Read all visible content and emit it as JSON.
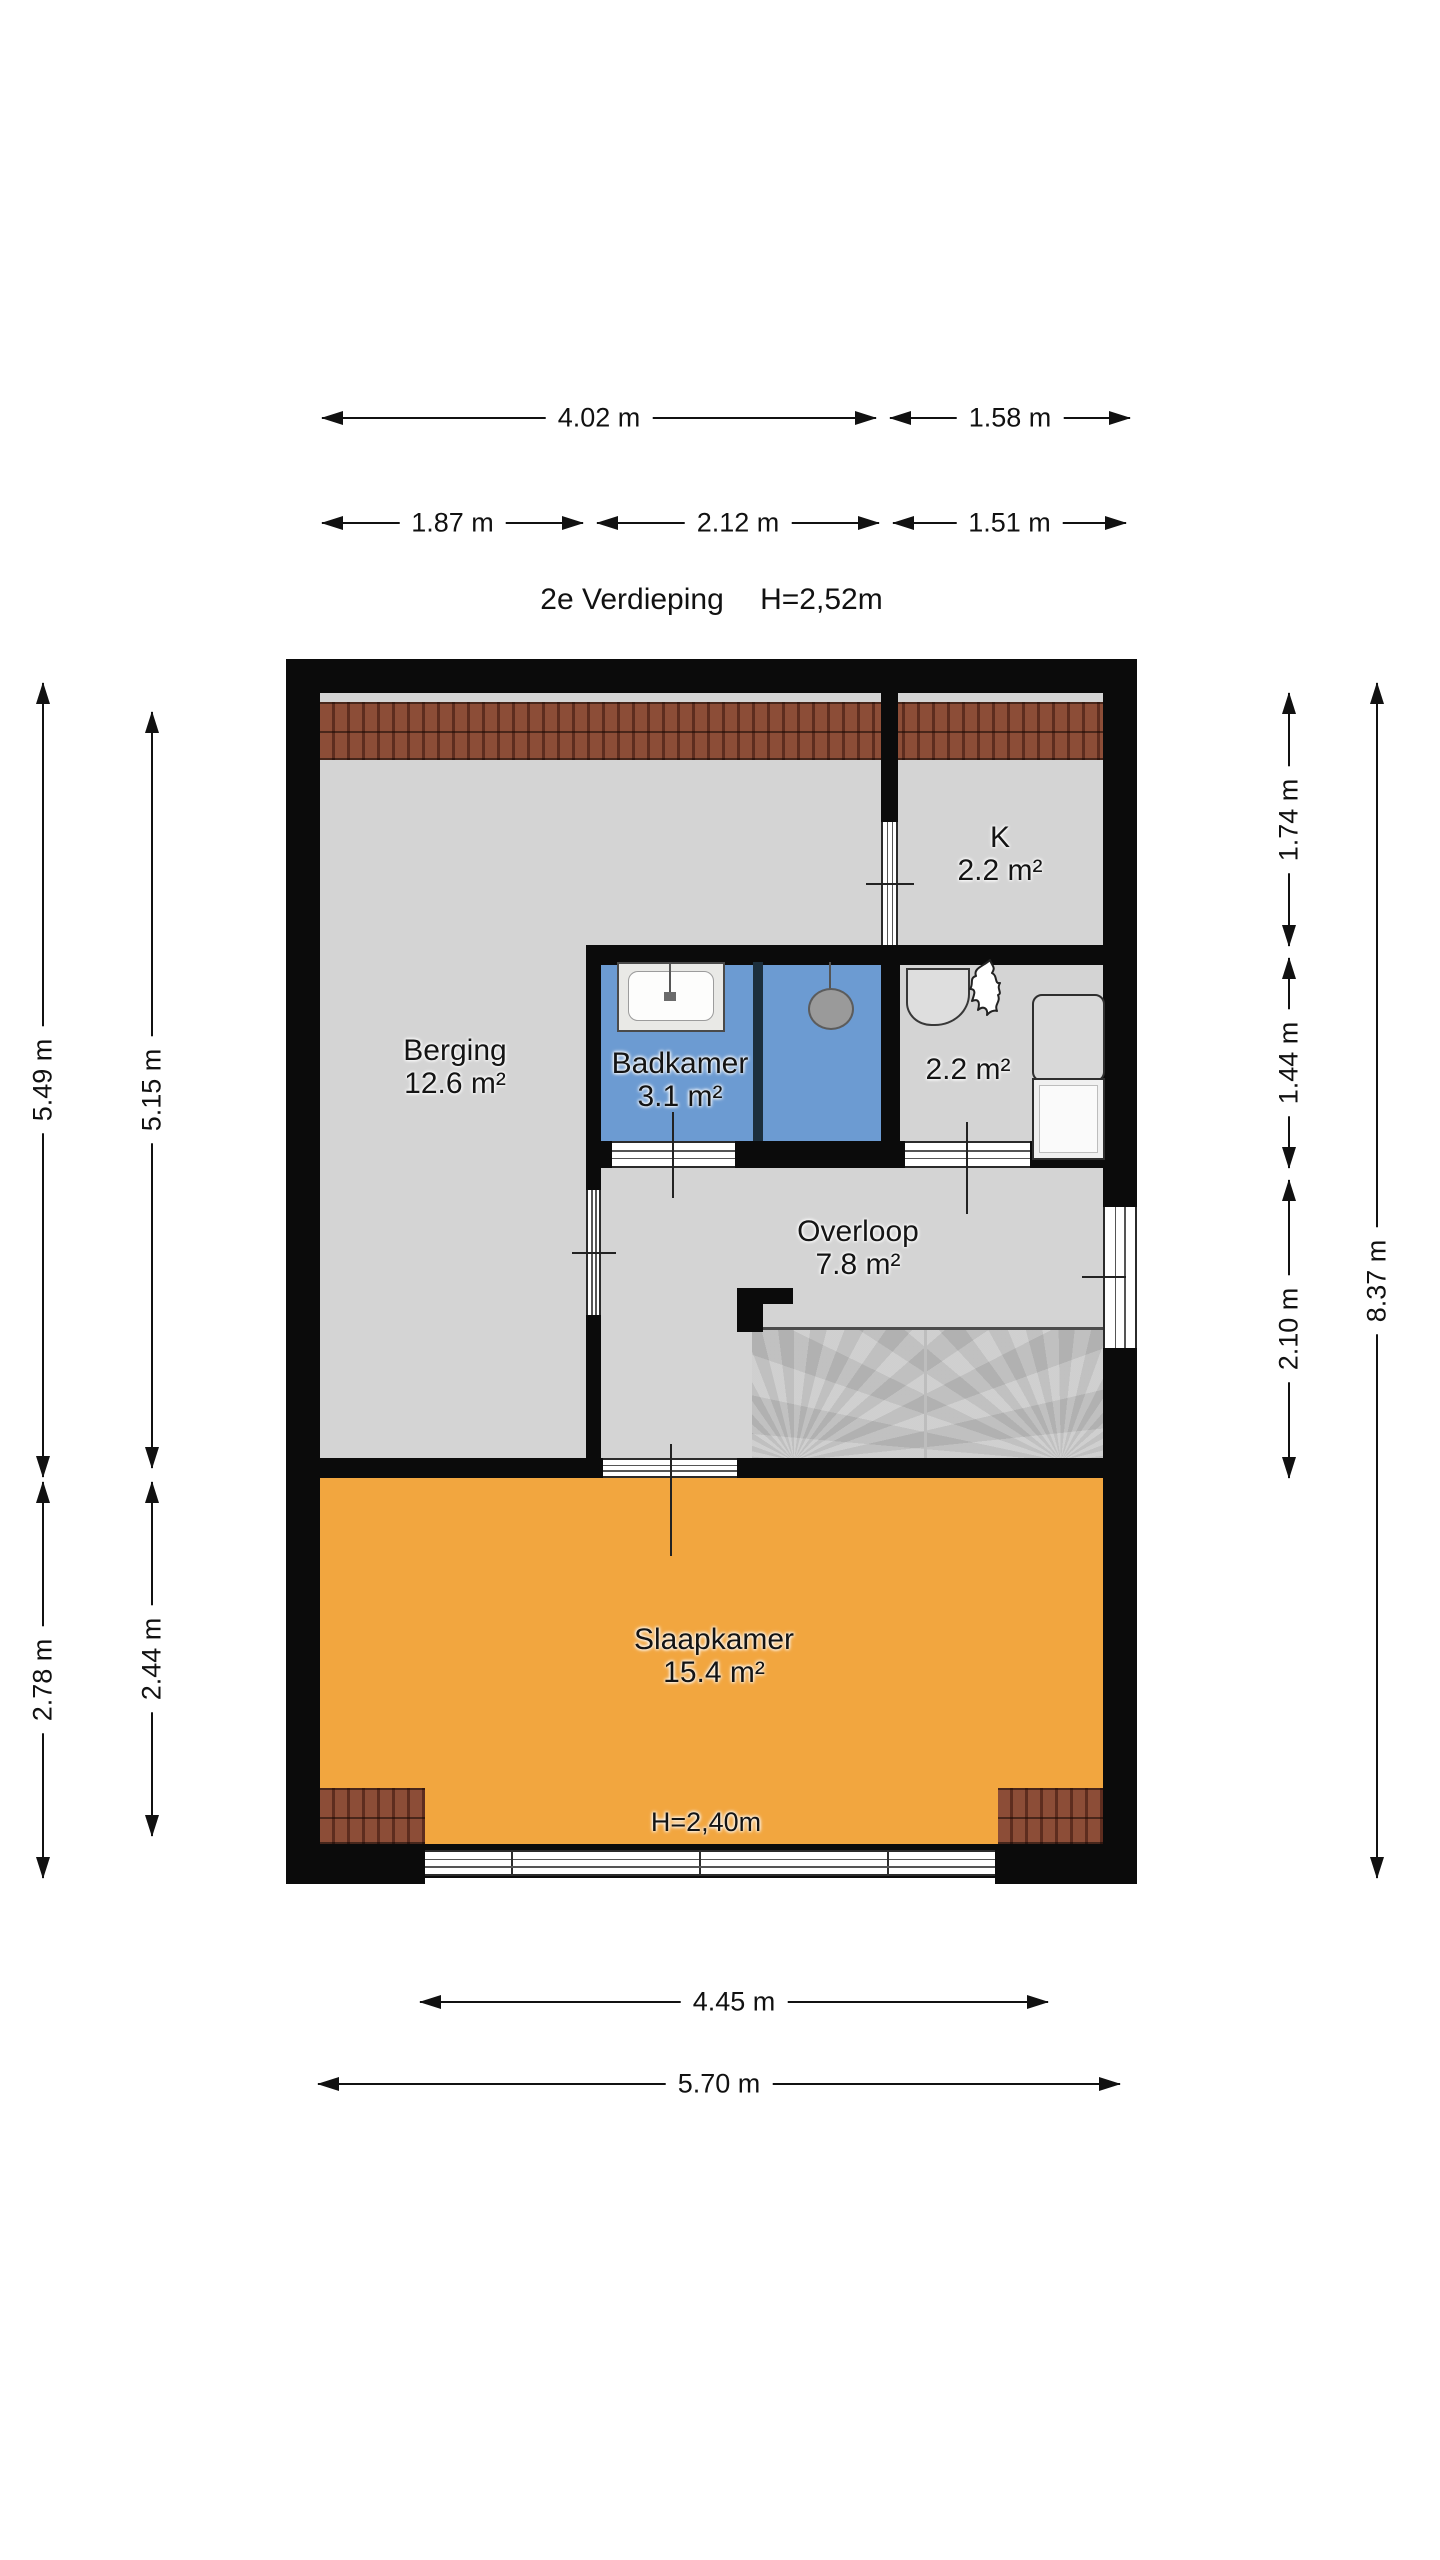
{
  "header": {
    "floor_name": "2e Verdieping",
    "ceiling_height": "H=2,52m"
  },
  "rooms": {
    "berging": {
      "name": "Berging",
      "area": "12.6 m²"
    },
    "badkamer": {
      "name": "Badkamer",
      "area": "3.1 m²"
    },
    "k": {
      "name": "K",
      "area": "2.2 m²"
    },
    "kast": {
      "area": "2.2 m²"
    },
    "overloop": {
      "name": "Overloop",
      "area": "7.8 m²"
    },
    "slaapkamer": {
      "name": "Slaapkamer",
      "area": "15.4 m²",
      "ceiling_height": "H=2,40m"
    }
  },
  "dimensions": {
    "top": [
      "4.02 m",
      "1.58 m",
      "1.87 m",
      "2.12 m",
      "1.51 m"
    ],
    "left": [
      "5.49 m",
      "5.15 m",
      "2.78 m",
      "2.44 m"
    ],
    "right": [
      "1.74 m",
      "1.44 m",
      "2.10 m",
      "8.37 m"
    ],
    "bottom": [
      "4.45 m",
      "5.70 m"
    ]
  },
  "colors": {
    "wall": "#0b0b0b",
    "floor": "#d4d4d4",
    "wet_room": "#6c9bd2",
    "bedroom": "#f2a63f",
    "stairs": "#c8c8c8",
    "roof_tiles": "#8c4d37"
  }
}
